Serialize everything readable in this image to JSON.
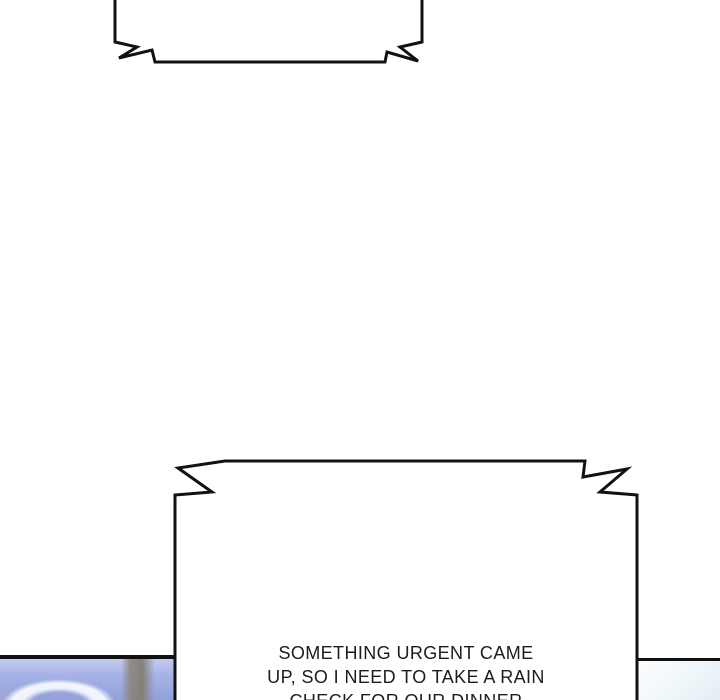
{
  "comic": {
    "top_bubble": {
      "text": ""
    },
    "bottom_bubble": {
      "line1": "SOMETHING URGENT CAME",
      "line2": "UP, SO I NEED TO TAKE A RAIN",
      "line3": "CHECK FOR OUR DINNER"
    }
  },
  "colors": {
    "page_background": "#ffffff",
    "ink": "#111111",
    "bubble_fill": "#ffffff",
    "text": "#1c1c1c",
    "left_photo_blue": "#9dabe0",
    "left_photo_highlight": "#f3f6ff",
    "left_photo_band": "#8e867c",
    "left_photo_pink": "#c6acbc",
    "right_photo_tint": "#e2eef3"
  }
}
